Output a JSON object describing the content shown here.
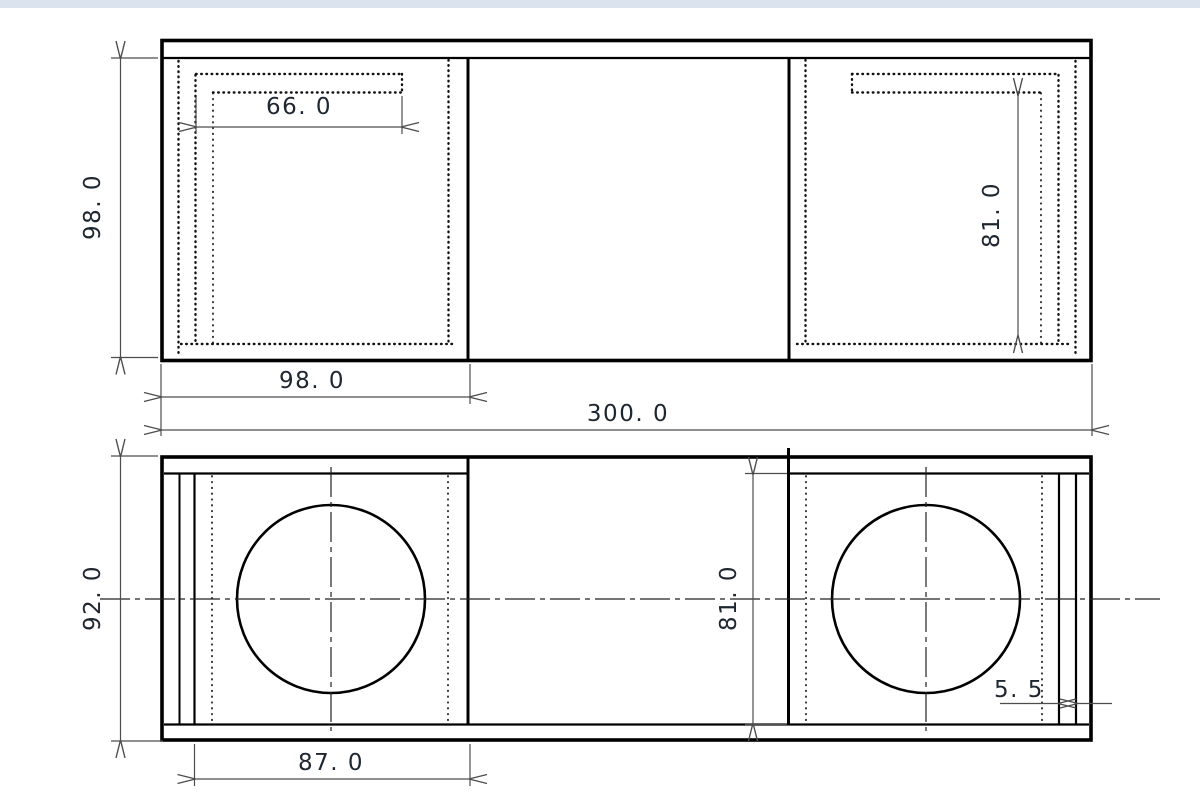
{
  "window": {
    "top_bar_color": "#dbe3ef",
    "background": "#ffffff"
  },
  "drawing": {
    "title": "speaker enclosure two-view technical drawing",
    "line_color": "#000000",
    "dim_color": "#4d4d4d",
    "text_color": "#1e2630",
    "views": [
      {
        "id": "top-view",
        "label": "top view"
      },
      {
        "id": "front-view",
        "label": "front view"
      }
    ],
    "dimensions": {
      "port_length": {
        "value": 66.0,
        "text": "66. 0"
      },
      "depth": {
        "value": 98.0,
        "text": "98. 0"
      },
      "left_section_width": {
        "value": 98.0,
        "text": "98. 0"
      },
      "overall_width": {
        "value": 300.0,
        "text": "300. 0"
      },
      "right_inner_depth": {
        "value": 81.0,
        "text": "81. 0"
      },
      "overall_height": {
        "value": 92.0,
        "text": "92. 0"
      },
      "inner_height": {
        "value": 81.0,
        "text": "81. 0"
      },
      "left_opening_width": {
        "value": 87.0,
        "text": "87. 0"
      },
      "slot_width": {
        "value": 5.5,
        "text": "5. 5"
      }
    }
  }
}
